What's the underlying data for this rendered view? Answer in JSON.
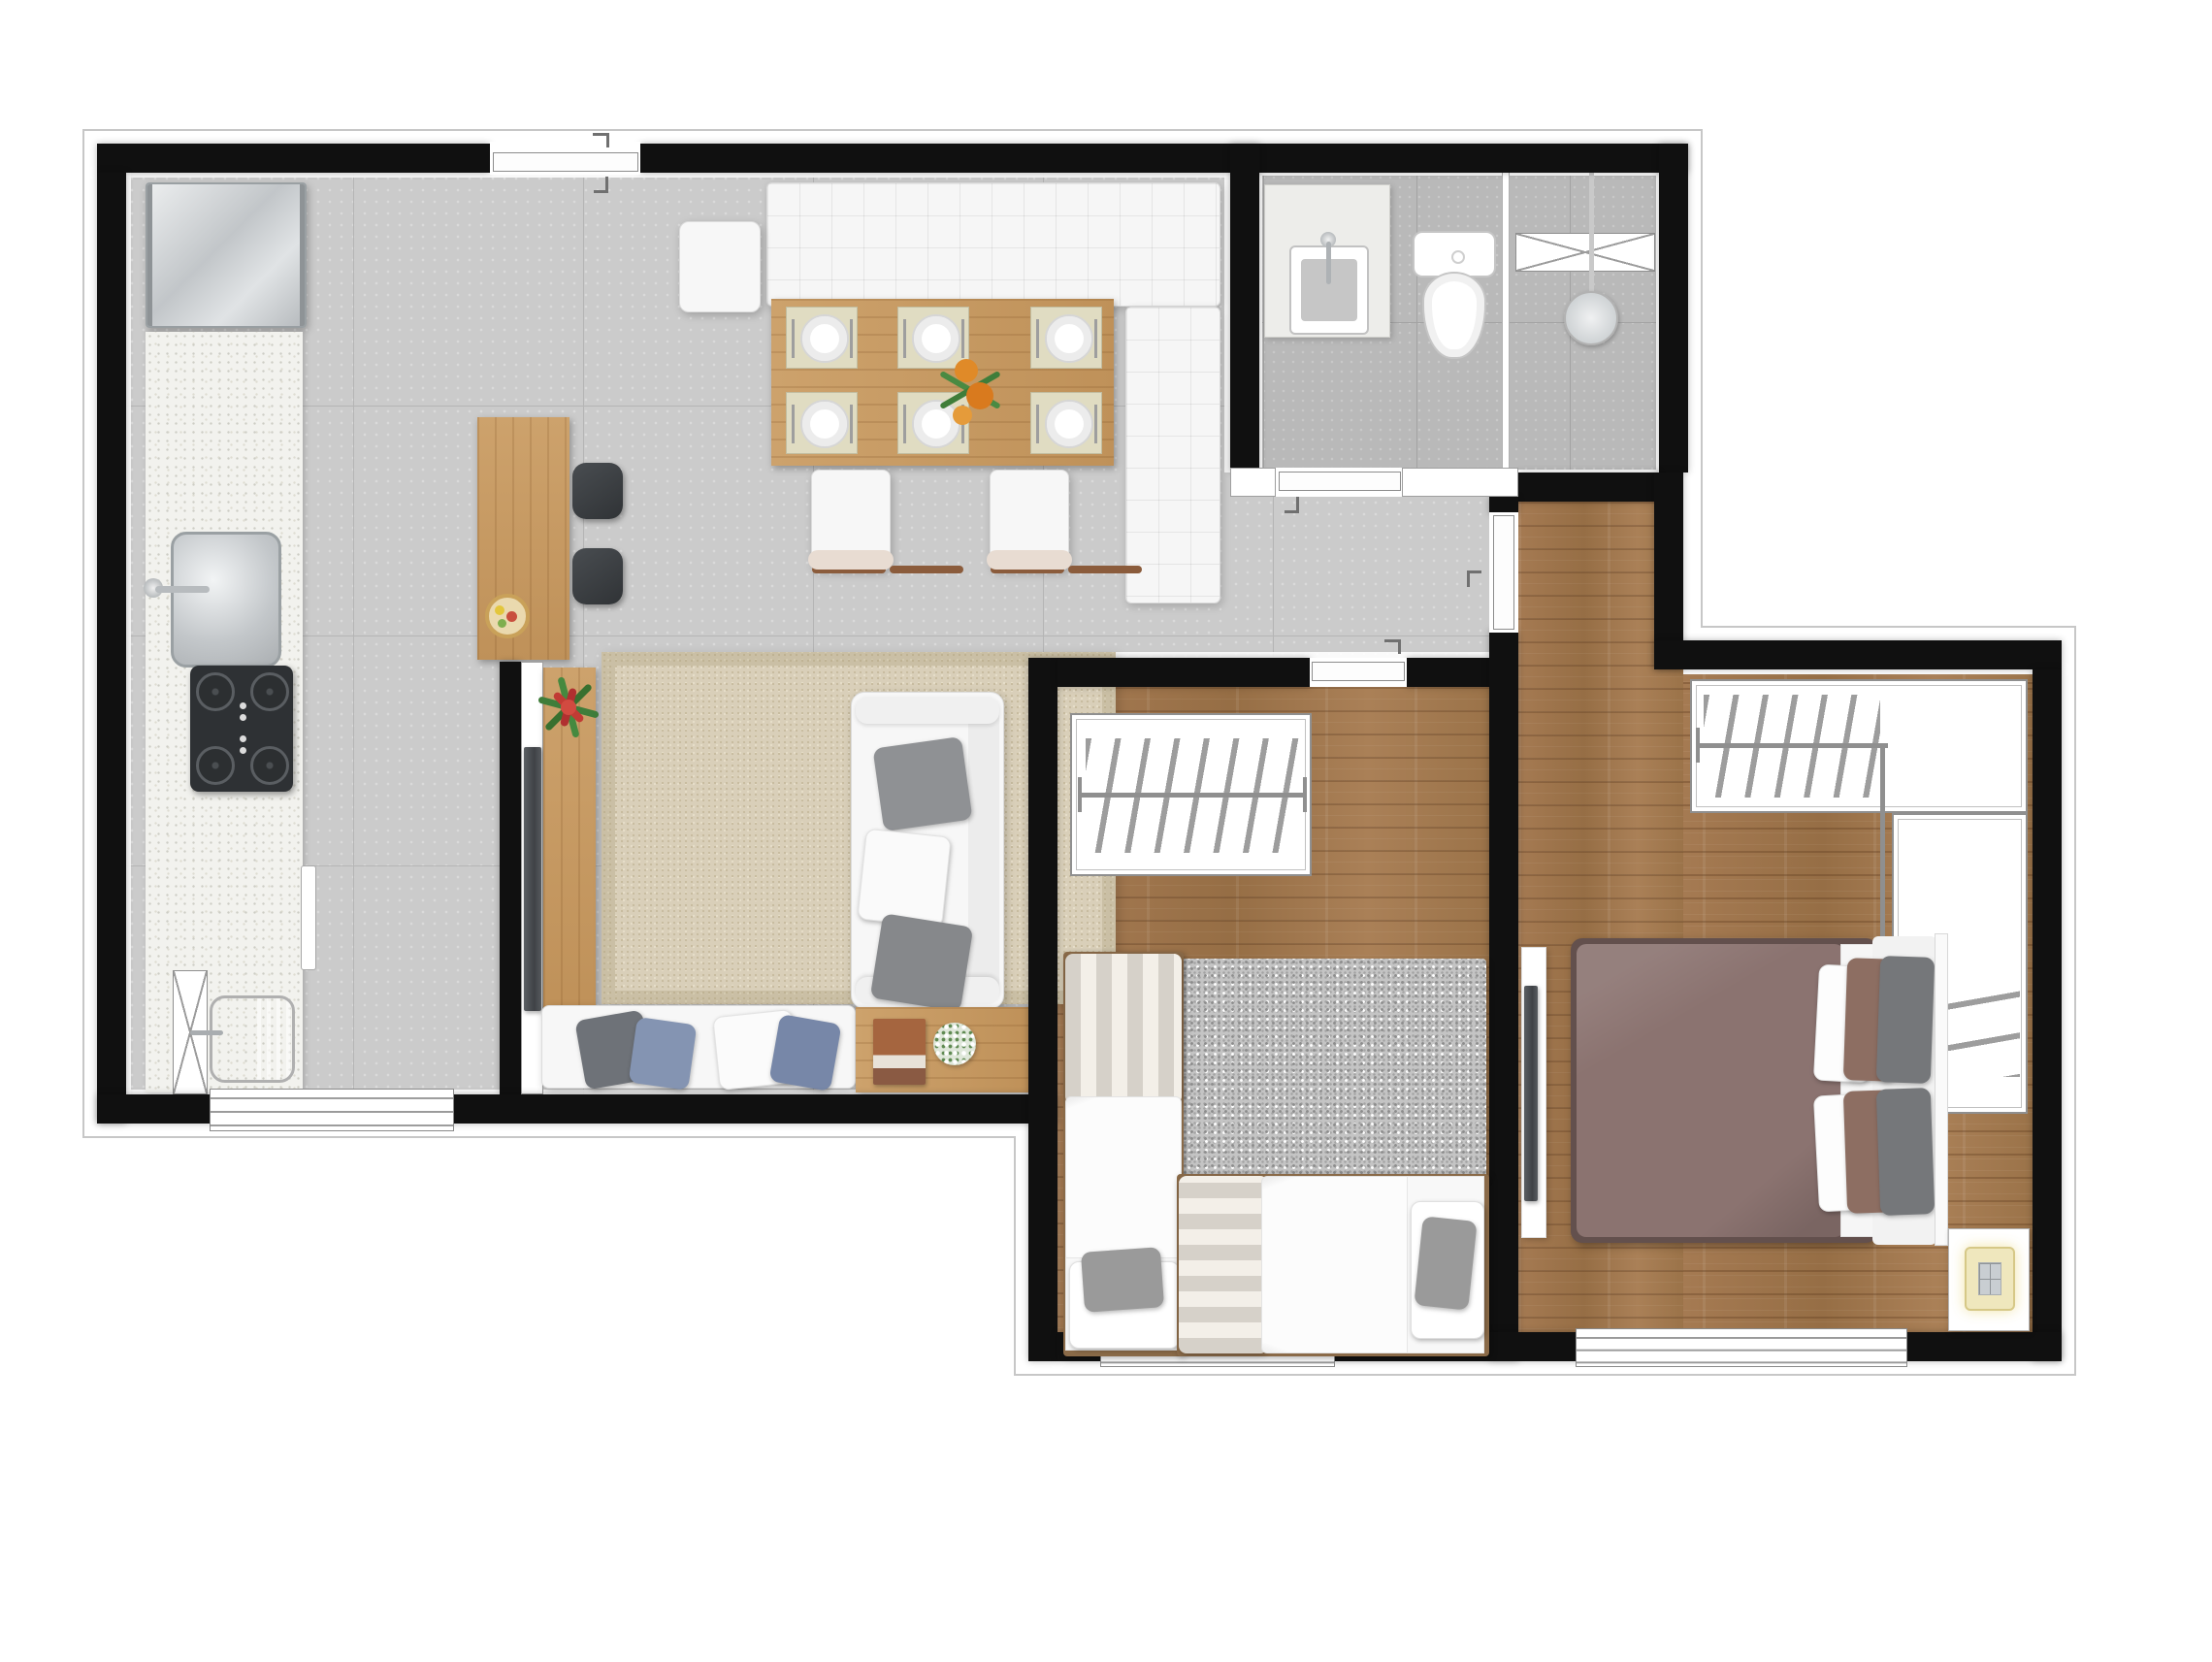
{
  "plan": {
    "kind": "apartment-floor-plan-top-view",
    "visible_text": [],
    "rooms": [
      {
        "id": "kitchen",
        "label": "Kitchen"
      },
      {
        "id": "living-dining",
        "label": "Living and dining room"
      },
      {
        "id": "service-area",
        "label": "Service area"
      },
      {
        "id": "bathroom",
        "label": "Bathroom"
      },
      {
        "id": "hall",
        "label": "Hall"
      },
      {
        "id": "bedroom-1",
        "label": "Bedroom 1 (two single beds)"
      },
      {
        "id": "bedroom-2",
        "label": "Bedroom 2 (double bed with closet)"
      }
    ],
    "inventory": {
      "place_settings": 6,
      "dining_chairs": 3,
      "bar_stools": 2,
      "single_beds": 2,
      "double_beds": 1,
      "wardrobes": 2,
      "windows": 3,
      "doors": 4
    }
  },
  "palette": {
    "wall": "#101010",
    "tile_floor": "#cbcbcb",
    "bath_tile": "#b9b9b9",
    "wood_floor": "#a07850",
    "wood_furniture": "#c79a66",
    "rug_beige": "#d9cfb9",
    "shag_rug": "#c4c4c4",
    "duvet_mauve": "#8b7370",
    "pillow_blue": "#8494b2",
    "pillow_gray": "#9a9a9a",
    "plant_red": "#c13b34",
    "plant_green": "#3f7d3a",
    "flower_orange": "#e08a28",
    "stool_dark": "#3a3d40"
  },
  "labels": {
    "plan": "Two-bedroom apartment floor plan",
    "entry_door": "entry-door",
    "fridge": "refrigerator",
    "counter": "kitchen-counter",
    "kitchen_sink": "kitchen-sink",
    "cooktop": "4-burner-cooktop",
    "oven_handle": "oven-handle",
    "utility_cabinet": "utility-cabinet",
    "laundry_tub": "laundry-tub",
    "service_window": "service-window",
    "breakfast_bar": "breakfast-bar",
    "fruit_bowl": "fruit-bowl",
    "bar_stool": "bar-stool",
    "half_wall": "tv-half-wall",
    "tv_living": "living-room-tv",
    "sideboard": "sideboard",
    "red_plant": "bromeliad-plant",
    "dining_table": "dining-table-6-seats",
    "place_setting": "place-setting",
    "centerpiece": "orange-flower-centerpiece",
    "corner_bench": "white-tufted-corner-bench",
    "dining_chair": "dining-chair",
    "area_rug": "beige-area-rug",
    "sofa": "white-two-seat-sofa",
    "daybed_bench": "cushion-bench",
    "side_table": "wood-side-table",
    "book": "book",
    "white_plant": "white-flower-pot",
    "vanity": "bathroom-vanity-sink",
    "toilet": "toilet",
    "shower_divider": "shower-glass-divider",
    "glass_shelf": "shower-glass-shelf",
    "shower_head": "shower-head",
    "bath_door": "bathroom-door",
    "bedroom1_door": "bedroom-1-door",
    "bedroom2_door": "bedroom-2-door",
    "wardrobe1": "bedroom-1-wardrobe",
    "closet2": "bedroom-2-closet",
    "hangers": "clothes-hangers",
    "shag_rug": "gray-shag-rug",
    "single_bed_v": "single-bed-vertical",
    "single_bed_h": "single-bed-horizontal",
    "double_bed": "double-bed",
    "headboard": "headboard",
    "nightstand": "nightstand-with-lamp",
    "tv_panel2": "bedroom-2-tv-panel",
    "bedroom_window": "bedroom-window"
  }
}
